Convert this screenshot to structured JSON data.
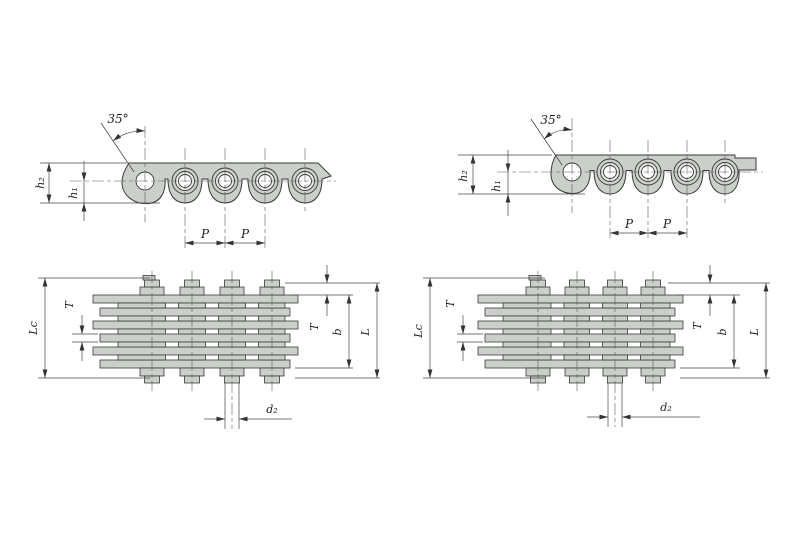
{
  "colors": {
    "plate_fill": "#cbcfca",
    "outline": "#3a3a3a",
    "dimension_line": "#474747",
    "background": "#ffffff",
    "text": "#1e1e1e"
  },
  "left_drawing": {
    "side_view": {
      "angle_label": "35°",
      "height_outer": "h₂",
      "height_inner": "h₁",
      "pitch_1": "P",
      "pitch_2": "P"
    },
    "plan_view": {
      "overall_length": "Lc",
      "plate_thickness_left": "T",
      "plate_thickness_right": "T",
      "inner_width": "b",
      "pin_length": "L",
      "pin_diameter": "d₂"
    }
  },
  "right_drawing": {
    "side_view": {
      "angle_label": "35°",
      "height_outer": "h₂",
      "height_inner": "h₁",
      "pitch_1": "P",
      "pitch_2": "P"
    },
    "plan_view": {
      "overall_length": "Lc",
      "plate_thickness_left": "T",
      "plate_thickness_right": "T",
      "inner_width": "b",
      "pin_length": "L",
      "pin_diameter": "d₂"
    }
  }
}
